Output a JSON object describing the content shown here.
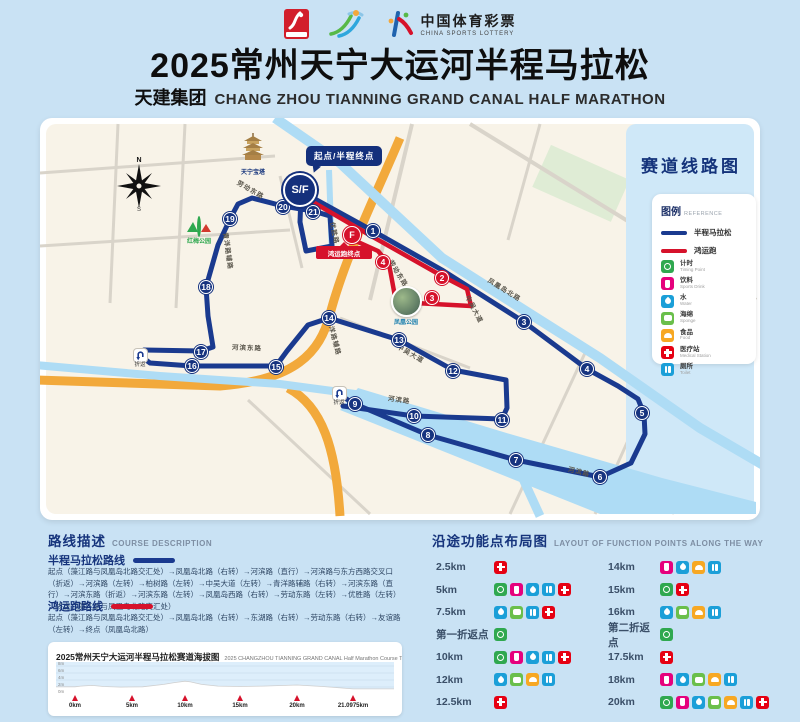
{
  "header": {
    "title": "2025常州天宁大运河半程马拉松",
    "title_prefix": "天建集团",
    "subtitle": "CHANG ZHOU TIANNING GRAND CANAL HALF MARATHON",
    "lottery_cn": "中国体育彩票",
    "lottery_en": "CHINA SPORTS LOTTERY"
  },
  "icon_colors": {
    "timing": "#2fa84f",
    "drink": "#e5017d",
    "water": "#1b9fd8",
    "sponge": "#6abf4b",
    "food": "#f7a823",
    "medical": "#e60113",
    "toilet": "#1b9fd8"
  },
  "map": {
    "panel_title": "赛道线路图",
    "sf_label": "S/F",
    "f_label": "F",
    "callout_start": "起点/半程终点",
    "callout_fun_finish": "鸿运跑终点",
    "uturn_label": "折返",
    "compass_n": "N",
    "landmarks": {
      "pagoda": "天宁宝塔",
      "park": "红梅公园",
      "photo": "凤凰公园"
    },
    "legend": {
      "title": "图例",
      "subtitle": "REFERENCE",
      "lines": [
        {
          "label": "半程马拉松",
          "color": "#1a3a8f"
        },
        {
          "label": "鸿运跑",
          "color": "#d6122b"
        }
      ],
      "items": [
        {
          "type": "timing",
          "label": "计时",
          "en": "Timing Point"
        },
        {
          "type": "drink",
          "label": "饮料",
          "en": "Sports Drink"
        },
        {
          "type": "water",
          "label": "水",
          "en": "Water"
        },
        {
          "type": "sponge",
          "label": "海绵",
          "en": "Sponge"
        },
        {
          "type": "food",
          "label": "食品",
          "en": "Food"
        },
        {
          "type": "medical",
          "label": "医疗站",
          "en": "Medical Station"
        },
        {
          "type": "toilet",
          "label": "厕所",
          "en": "Toilet"
        }
      ]
    },
    "badges": [
      {
        "n": "1",
        "c": "blue",
        "x": 333,
        "y": 113
      },
      {
        "n": "2",
        "c": "red",
        "x": 402,
        "y": 160
      },
      {
        "n": "3",
        "c": "red",
        "x": 392,
        "y": 180
      },
      {
        "n": "4",
        "c": "red",
        "x": 343,
        "y": 144
      },
      {
        "n": "3",
        "c": "blue",
        "x": 484,
        "y": 204
      },
      {
        "n": "4",
        "c": "blue",
        "x": 547,
        "y": 251
      },
      {
        "n": "5",
        "c": "blue",
        "x": 602,
        "y": 295
      },
      {
        "n": "6",
        "c": "blue",
        "x": 560,
        "y": 359
      },
      {
        "n": "7",
        "c": "blue",
        "x": 476,
        "y": 342
      },
      {
        "n": "8",
        "c": "blue",
        "x": 388,
        "y": 317
      },
      {
        "n": "9",
        "c": "blue",
        "x": 315,
        "y": 286
      },
      {
        "n": "10",
        "c": "blue",
        "x": 374,
        "y": 298
      },
      {
        "n": "11",
        "c": "blue",
        "x": 462,
        "y": 302
      },
      {
        "n": "12",
        "c": "blue",
        "x": 413,
        "y": 253
      },
      {
        "n": "13",
        "c": "blue",
        "x": 359,
        "y": 222
      },
      {
        "n": "14",
        "c": "blue",
        "x": 289,
        "y": 200
      },
      {
        "n": "15",
        "c": "blue",
        "x": 236,
        "y": 249
      },
      {
        "n": "16",
        "c": "blue",
        "x": 152,
        "y": 248
      },
      {
        "n": "17",
        "c": "blue",
        "x": 161,
        "y": 234
      },
      {
        "n": "18",
        "c": "blue",
        "x": 166,
        "y": 169
      },
      {
        "n": "19",
        "c": "blue",
        "x": 190,
        "y": 101
      },
      {
        "n": "20",
        "c": "blue",
        "x": 243,
        "y": 89
      },
      {
        "n": "21",
        "c": "blue",
        "x": 273,
        "y": 94
      }
    ],
    "uturns": [
      {
        "x": 299,
        "y": 277
      },
      {
        "x": 100,
        "y": 239
      }
    ],
    "road_labels": [
      {
        "t": "劳动东路",
        "x": 196,
        "y": 66,
        "r": 30
      },
      {
        "t": "劳动东路",
        "x": 344,
        "y": 150,
        "r": 58
      },
      {
        "t": "凤凰岛北路",
        "x": 446,
        "y": 166,
        "r": 32
      },
      {
        "t": "河滨东路",
        "x": 192,
        "y": 224,
        "r": 2
      },
      {
        "t": "河滨路",
        "x": 348,
        "y": 276,
        "r": 8
      },
      {
        "t": "河滨路",
        "x": 528,
        "y": 348,
        "r": 14
      },
      {
        "t": "中吴大道",
        "x": 420,
        "y": 186,
        "r": 62
      },
      {
        "t": "中吴大道",
        "x": 356,
        "y": 230,
        "r": 30
      },
      {
        "t": "青洋路辅路",
        "x": 170,
        "y": 128,
        "r": 82
      },
      {
        "t": "青洋路辅路",
        "x": 276,
        "y": 214,
        "r": 75
      },
      {
        "t": "优胜路",
        "x": 284,
        "y": 110,
        "r": 78
      }
    ]
  },
  "course": {
    "heading": "路线描述",
    "heading_en": "COURSE DESCRIPTION",
    "half": {
      "name": "半程马拉松路线",
      "desc": "起点（藻江路与凤凰岛北路交汇处）→凤凰岛北路（右转）→河滨路（直行）→河滨路与东方西路交叉口（折返）→河滨路（左转）→柏树路（左转）→中吴大道（左转）→青洋路辅路（右转）→河滨东路（直行）→河滨东路（折返）→河滨东路（左转）→凤凰岛西路（右转）→劳动东路（左转）→优胜路（左转）→终点（藻江路与凤凰岛北路交汇处）"
    },
    "fun": {
      "name": "鸿运跑路线",
      "desc": "起点（藻江路与凤凰岛北路交汇处）→凤凰岛北路（右转）→东湖路（右转）→劳动东路（右转）→友谊路（左转）→终点（凤凰岛北路）"
    }
  },
  "function_points": {
    "heading": "沿途功能点布局图",
    "heading_en": "LAYOUT OF FUNCTION POINTS ALONG THE WAY",
    "left": [
      {
        "label": "2.5km",
        "icons": [
          "medical"
        ]
      },
      {
        "label": "5km",
        "icons": [
          "timing",
          "drink",
          "water",
          "toilet",
          "medical"
        ]
      },
      {
        "label": "7.5km",
        "icons": [
          "water",
          "sponge",
          "toilet",
          "medical"
        ]
      },
      {
        "label": "第一折返点",
        "icons": [
          "timing"
        ]
      },
      {
        "label": "10km",
        "icons": [
          "timing",
          "drink",
          "water",
          "toilet",
          "medical"
        ]
      },
      {
        "label": "12km",
        "icons": [
          "water",
          "sponge",
          "food",
          "toilet"
        ]
      },
      {
        "label": "12.5km",
        "icons": [
          "medical"
        ]
      }
    ],
    "right": [
      {
        "label": "14km",
        "icons": [
          "drink",
          "water",
          "food",
          "toilet"
        ]
      },
      {
        "label": "15km",
        "icons": [
          "timing",
          "medical"
        ]
      },
      {
        "label": "16km",
        "icons": [
          "water",
          "sponge",
          "food",
          "toilet"
        ]
      },
      {
        "label": "第二折返点",
        "icons": [
          "timing"
        ]
      },
      {
        "label": "17.5km",
        "icons": [
          "medical"
        ]
      },
      {
        "label": "18km",
        "icons": [
          "drink",
          "water",
          "sponge",
          "food",
          "toilet"
        ]
      },
      {
        "label": "20km",
        "icons": [
          "timing",
          "drink",
          "water",
          "sponge",
          "food",
          "toilet",
          "medical"
        ]
      }
    ]
  },
  "chart_data": {
    "type": "area",
    "title": "2025常州天宁大运河半程马拉松赛道海拔图",
    "subtitle": "2025 CHANGZHOU TIANNING GRAND CANAL Half Marathon Course Terrain",
    "x_ticks": [
      {
        "km": 0,
        "label": "0km"
      },
      {
        "km": 5,
        "label": "5km"
      },
      {
        "km": 10,
        "label": "10km"
      },
      {
        "km": 15,
        "label": "15km"
      },
      {
        "km": 20,
        "label": "20km"
      },
      {
        "km": 21.0975,
        "label": "21.0975km"
      }
    ],
    "y_ticks": [
      "8m",
      "6m",
      "4m",
      "2m",
      "0m"
    ],
    "ylim": [
      0,
      8
    ],
    "series": [
      {
        "name": "海拔",
        "x": [
          0,
          0.5,
          1.5,
          2.5,
          4,
          6,
          8,
          9,
          10,
          10.5,
          11.5,
          13,
          15,
          17,
          19,
          20,
          20.5,
          21.0975
        ],
        "y": [
          3.2,
          3.4,
          3.6,
          3.3,
          3.1,
          3.2,
          3.9,
          4.4,
          4.8,
          4.6,
          3.9,
          3.4,
          3.3,
          3.4,
          3.6,
          3.7,
          3.3,
          2.6
        ]
      }
    ],
    "marker_color": "#d6122b"
  }
}
